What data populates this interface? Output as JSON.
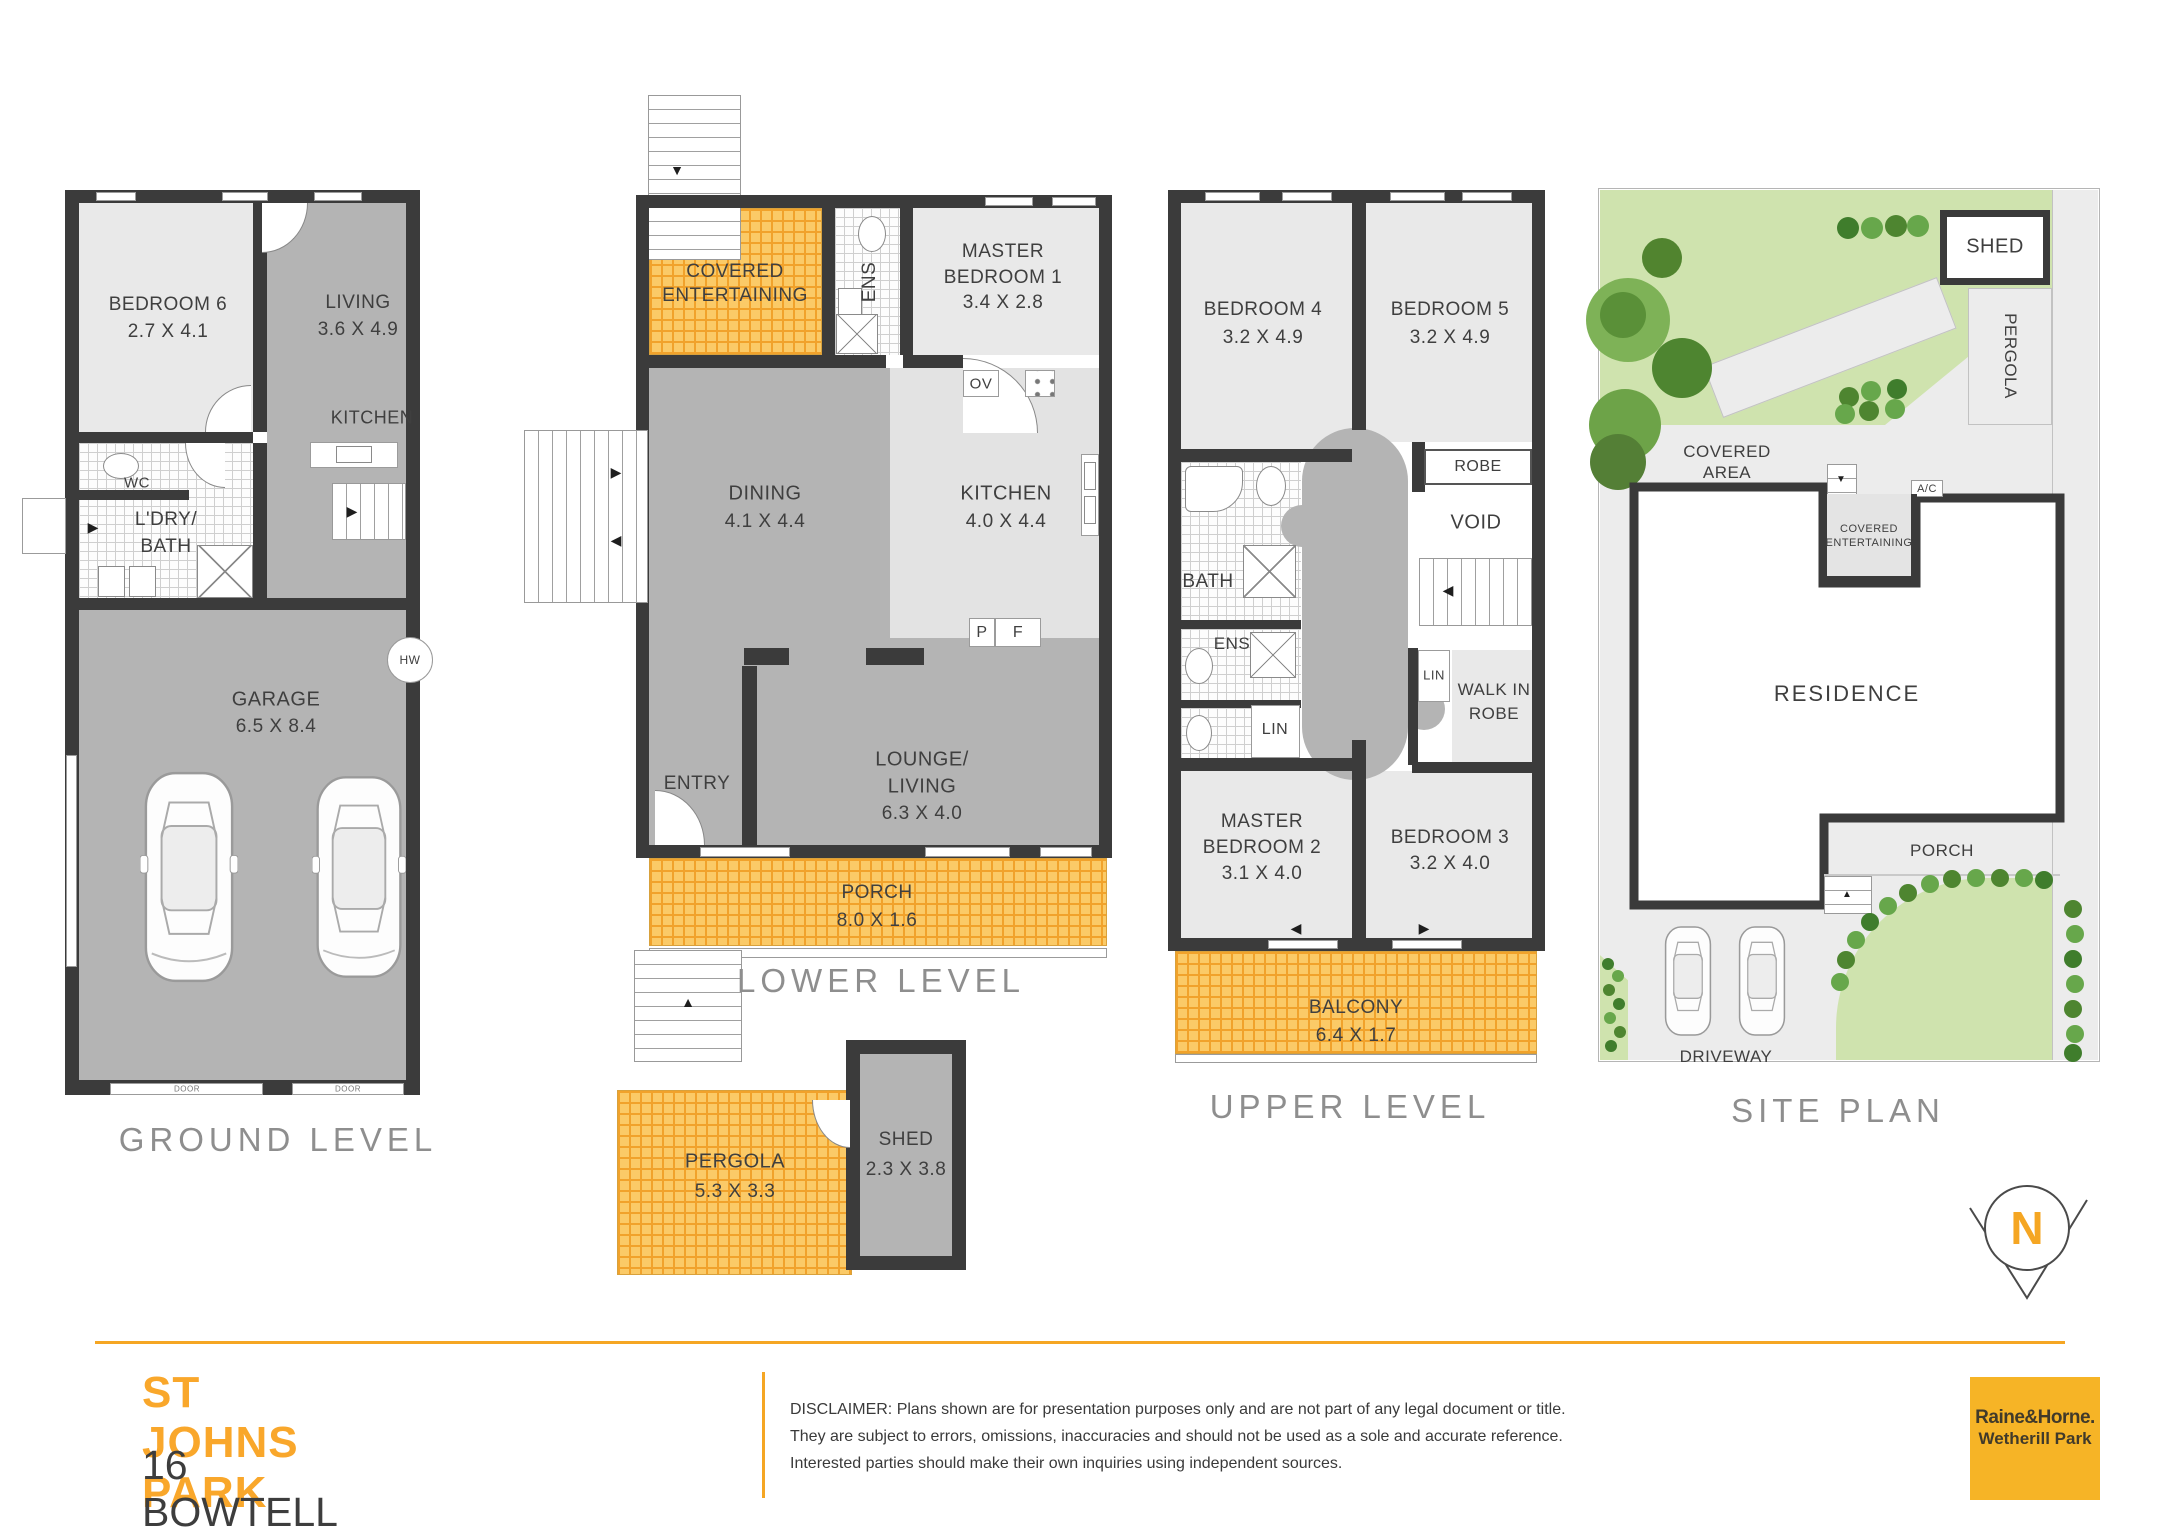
{
  "colors": {
    "accent": "#F5A623",
    "wall": "#3B3B3B",
    "room_light": "#E9E9E9",
    "room_mid": "#B4B4B4",
    "tile_yellow": "#FBCA67",
    "lawn": "#CFE3AE"
  },
  "icons": {
    "arrow_up": "▲",
    "arrow_down": "▼",
    "arrow_left": "◀",
    "arrow_right": "▶"
  },
  "ground_level": {
    "title": "GROUND LEVEL",
    "bedroom6": {
      "name": "BEDROOM 6",
      "dims": "2.7 X 4.1"
    },
    "living": {
      "name": "LIVING",
      "dims": "3.6 X 4.9"
    },
    "kitchen": {
      "name": "KITCHEN"
    },
    "wc": {
      "name": "WC"
    },
    "laundry_bath": {
      "line1": "L'DRY/",
      "line2": "BATH"
    },
    "garage": {
      "name": "GARAGE",
      "dims": "6.5 X 8.4"
    },
    "hot_water": "HW",
    "door_label": "DOOR"
  },
  "lower_level": {
    "title": "LOWER LEVEL",
    "covered_entertaining": {
      "line1": "COVERED",
      "line2": "ENTERTAINING"
    },
    "ens": {
      "name": "ENS"
    },
    "master_bedroom1": {
      "line1": "MASTER",
      "line2": "BEDROOM 1",
      "dims": "3.4 X 2.8"
    },
    "oven": "OV",
    "pantry": "P",
    "fridge": "F",
    "dining": {
      "name": "DINING",
      "dims": "4.1 X 4.4"
    },
    "kitchen": {
      "name": "KITCHEN",
      "dims": "4.0 X 4.4"
    },
    "lounge_living": {
      "line1": "LOUNGE/",
      "line2": "LIVING",
      "dims": "6.3 X 4.0"
    },
    "entry": {
      "name": "ENTRY"
    },
    "porch": {
      "name": "PORCH",
      "dims": "8.0 X 1.6"
    },
    "pergola": {
      "name": "PERGOLA",
      "dims": "5.3 X 3.3"
    },
    "shed": {
      "name": "SHED",
      "dims": "2.3 X 3.8"
    }
  },
  "upper_level": {
    "title": "UPPER LEVEL",
    "bedroom4": {
      "name": "BEDROOM 4",
      "dims": "3.2 X 4.9"
    },
    "bedroom5": {
      "name": "BEDROOM 5",
      "dims": "3.2 X 4.9"
    },
    "robe": {
      "name": "ROBE"
    },
    "void": {
      "name": "VOID"
    },
    "bath": {
      "name": "BATH"
    },
    "ens": {
      "name": "ENS"
    },
    "linen1": "LIN",
    "linen2": "LIN",
    "walk_in_robe": {
      "line1": "WALK IN",
      "line2": "ROBE"
    },
    "master_bedroom2": {
      "line1": "MASTER",
      "line2": "BEDROOM 2",
      "dims": "3.1 X 4.0"
    },
    "bedroom3": {
      "name": "BEDROOM 3",
      "dims": "3.2 X 4.0"
    },
    "balcony": {
      "name": "BALCONY",
      "dims": "6.4 X 1.7"
    }
  },
  "site_plan": {
    "title": "SITE PLAN",
    "shed": "SHED",
    "pergola": "PERGOLA",
    "covered_area": {
      "line1": "COVERED",
      "line2": "AREA"
    },
    "ac": "A/C",
    "covered_entertaining": {
      "line1": "COVERED",
      "line2": "ENTERTAINING"
    },
    "residence": "RESIDENCE",
    "porch": "PORCH",
    "driveway": "DRIVEWAY",
    "compass": "N"
  },
  "footer": {
    "suburb": "ST JOHNS PARK",
    "address": "16 BOWTELL AVENUE",
    "disclaimer": "DISCLAIMER: Plans shown are for presentation purposes only and are not part of any legal document or title. They are subject to errors, omissions, inaccuracies and should not be used as a sole and accurate reference. Interested parties should make their own inquiries using independent sources.",
    "logo_line1": "Raine&Horne.",
    "logo_line2": "Wetherill Park"
  }
}
